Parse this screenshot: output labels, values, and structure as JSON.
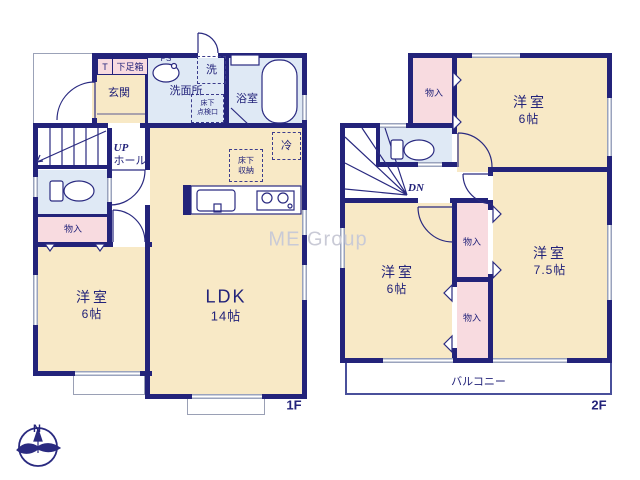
{
  "watermark": "ME Group",
  "compass": {
    "north": "N"
  },
  "colors": {
    "wall": "#23237a",
    "room_floor": "#f8e9c6",
    "wet_floor": "#dfe9f5",
    "closet_floor": "#f8dbe0",
    "window": "#9aa3bd",
    "text": "#23237a",
    "watermark": "#c9cad6"
  },
  "floor1": {
    "label": "1F",
    "entrance": "玄関",
    "t_cabinet": "T",
    "shoe_cabinet": "下足箱",
    "pipe_space": "PS",
    "washer": "洗",
    "washroom": "洗面所",
    "access_hatch": "床下\n点検口",
    "bathroom": "浴室",
    "stairs_up": "UP",
    "hall": "ホール",
    "closet": "物入",
    "fridge": "冷",
    "floor_storage": "床下\n収納",
    "bedroom": {
      "name": "洋室",
      "size": "6帖"
    },
    "ldk": {
      "name": "LDK",
      "size": "14帖"
    }
  },
  "floor2": {
    "label": "2F",
    "stairs_down": "DN",
    "closet_north": "物入",
    "closet_center": "物入",
    "closet_south": "物入",
    "balcony": "バルコニー",
    "bedroom_ne": {
      "name": "洋室",
      "size": "6帖"
    },
    "bedroom_sw": {
      "name": "洋室",
      "size": "6帖"
    },
    "bedroom_se": {
      "name": "洋室",
      "size": "7.5帖"
    }
  }
}
